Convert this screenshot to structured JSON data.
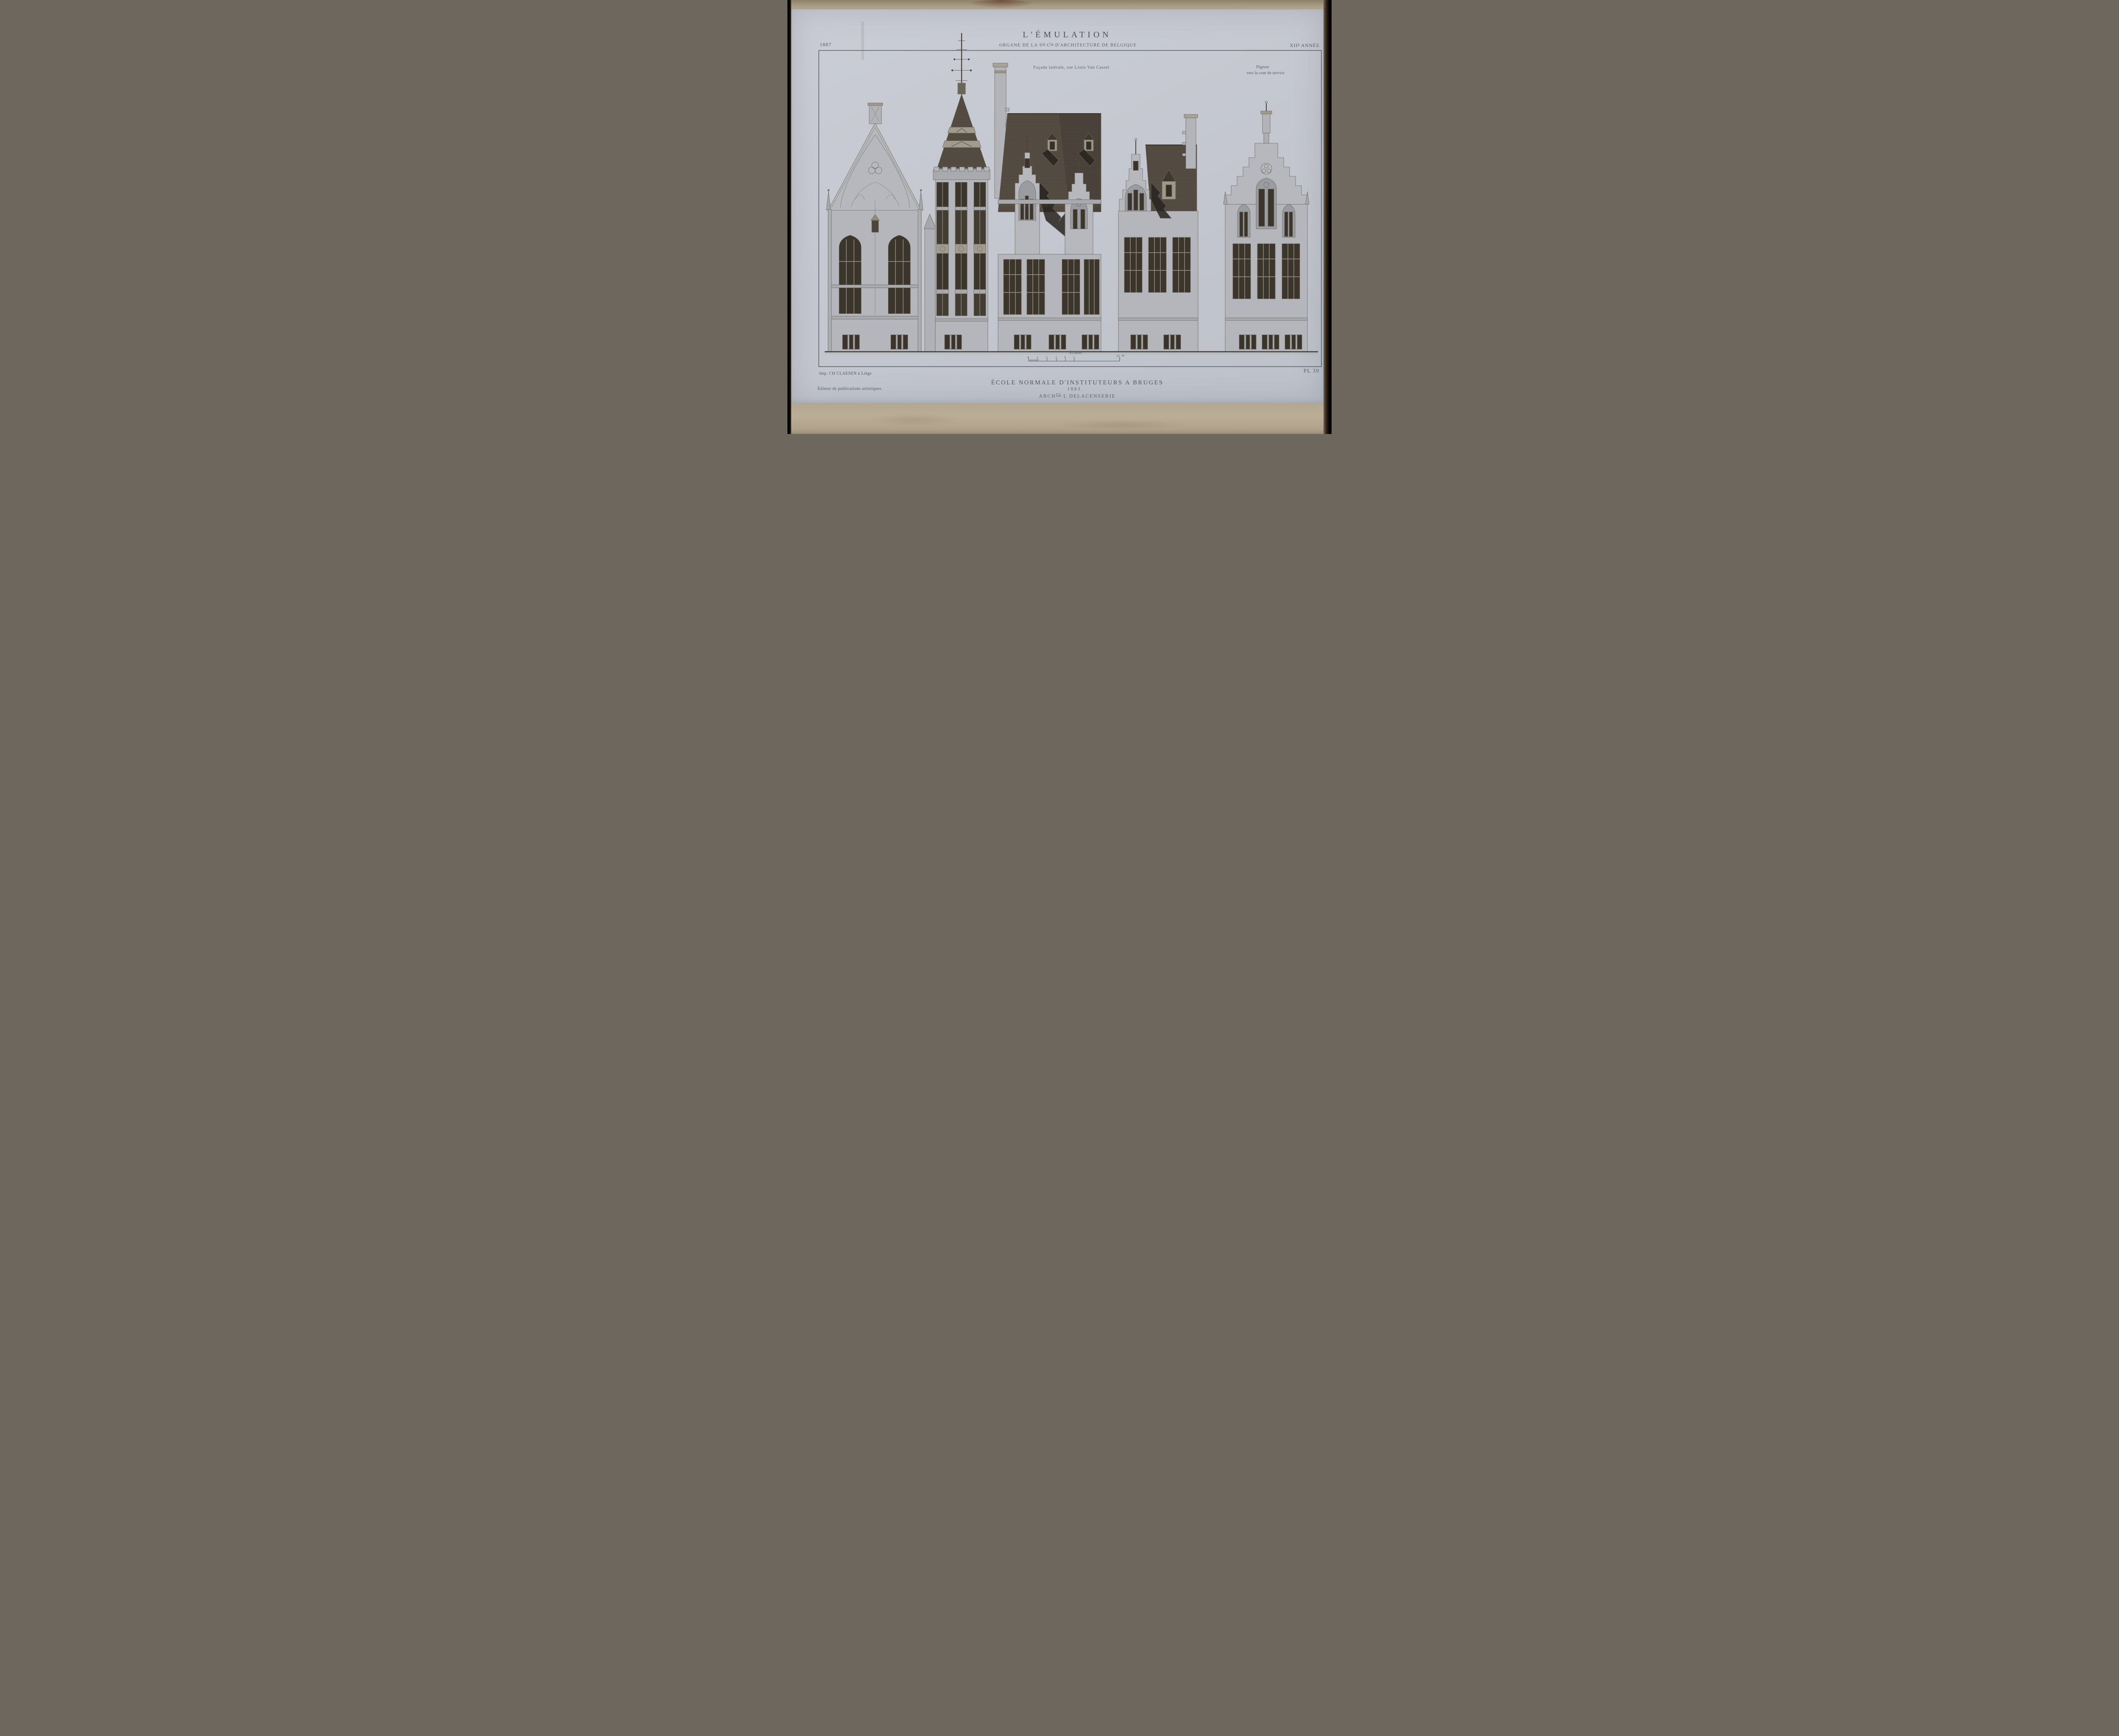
{
  "header": {
    "year_left": "1887",
    "journal_title": "L'ÉMULATION",
    "subtitle_parts": {
      "p1": "ORGANE DE LA S",
      "s1": "té",
      "p2": " C",
      "s2": "le",
      "p3": " D'ARCHITECTURE DE BELGIQUE"
    },
    "annee_roman": "XII",
    "annee_sup": "e",
    "annee_word": " ANNÉE"
  },
  "captions": {
    "facade_laterale": "Façade latérale, rue Louis Van Cassel",
    "pignon_line1": "Pignon",
    "pignon_line2": "vers la cour de service"
  },
  "scale_bar": {
    "label": "Échelle.",
    "tick_labels": [
      "0",
      "1",
      "2",
      "3",
      "4",
      "5",
      "10"
    ],
    "unit": "m"
  },
  "footer": {
    "printer": "Imp. CH CLAESEN à Liège",
    "publisher": "Éditeur de publications artistiques.",
    "plate_label": "PL 39",
    "work_title": "ÉCOLE NORMALE D'INSTITUTEURS A BRUGES",
    "work_year": "1883",
    "architect_prefix": "ARCH",
    "architect_sup": "TE",
    "architect_rest": " L DELACENSERIE"
  },
  "drawing": {
    "sections": [
      "pointed-gable-pavilion",
      "corner-tower-with-spire",
      "side-wing-rue-louis-van-cassel",
      "intermediate-wing",
      "stepped-gable-service-court"
    ]
  },
  "colors": {
    "paper": "#c5c8d0",
    "mat_board": "#b5a890",
    "edge_black": "#000000",
    "print_ink": "#585962",
    "drawing_line": "#6d675b",
    "wall_tone": "#b5b6bb",
    "window_dark": "#3a342b",
    "roof_dark": "#554e43",
    "shadow_dark": "#2a2620"
  }
}
